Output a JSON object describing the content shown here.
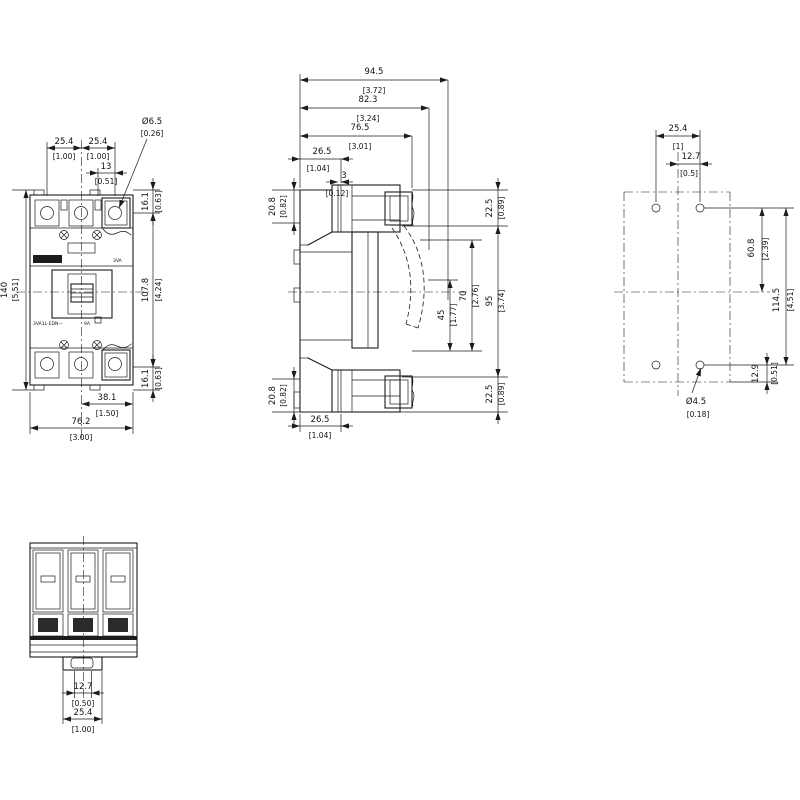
{
  "front_view": {
    "face_text": {
      "brand": "3VA",
      "type_line": "3VA1L-EDN—",
      "rating": "9A"
    },
    "dims": {
      "pitch_left": {
        "mm": "25.4",
        "in": "[1.00]"
      },
      "pitch_right": {
        "mm": "25.4",
        "in": "[1.00]"
      },
      "hole_offset": {
        "mm": "13",
        "in": "[0.51]"
      },
      "hole_dia": {
        "mm": "Ø6.5",
        "in": "[0.26]"
      },
      "total_height": {
        "mm": "140",
        "in": "[5.51]"
      },
      "terminal_top": {
        "mm": "16.1",
        "in": "[0.63]"
      },
      "cover_height": {
        "mm": "107.8",
        "in": "[4.24]"
      },
      "terminal_bottom": {
        "mm": "16.1",
        "in": "[0.63]"
      },
      "half_width": {
        "mm": "38.1",
        "in": "[1.50]"
      },
      "total_width": {
        "mm": "76.2",
        "in": "[3.00]"
      }
    }
  },
  "side_view": {
    "dims": {
      "depth_total": {
        "mm": "94.5",
        "in": "[3.72]"
      },
      "depth_terminal": {
        "mm": "82.3",
        "in": "[3.24]"
      },
      "depth_body": {
        "mm": "76.5",
        "in": "[3.01]"
      },
      "front_step": {
        "mm": "26.5",
        "in": "[1.04]"
      },
      "handle_step": {
        "mm": "3",
        "in": "[0.12]"
      },
      "back_top_offset": {
        "mm": "20.8",
        "in": "[0.82]"
      },
      "back_bottom_offset": {
        "mm": "20.8",
        "in": "[0.82]"
      },
      "front_top_offset": {
        "mm": "22.5",
        "in": "[0.89]"
      },
      "clearance_45": {
        "mm": "45",
        "in": "[1.77]"
      },
      "clearance_70": {
        "mm": "70",
        "in": "[2.76]"
      },
      "front_span": {
        "mm": "95",
        "in": "[3.74]"
      },
      "front_bottom_offset": {
        "mm": "22.5",
        "in": "[0.89]"
      },
      "base_depth": {
        "mm": "26.5",
        "in": "[1.04]"
      }
    }
  },
  "drilling_plan": {
    "dims": {
      "hole_pitch": {
        "mm": "25.4",
        "in": "[1]"
      },
      "hole_half_pitch": {
        "mm": "12.7",
        "in": "[0.5]"
      },
      "upper_hole_span": {
        "mm": "60.8",
        "in": "[2.39]"
      },
      "hole_row_span": {
        "mm": "114.5",
        "in": "[4.51]"
      },
      "lower_hole_offset": {
        "mm": "12.9",
        "in": "[0.51]"
      },
      "hole_dia": {
        "mm": "Ø4.5",
        "in": "[0.18]"
      }
    }
  },
  "bottom_view": {
    "dims": {
      "din_tab_width": {
        "mm": "12.7",
        "in": "[0.50]"
      },
      "din_foot_width": {
        "mm": "25.4",
        "in": "[1.00]"
      }
    }
  }
}
